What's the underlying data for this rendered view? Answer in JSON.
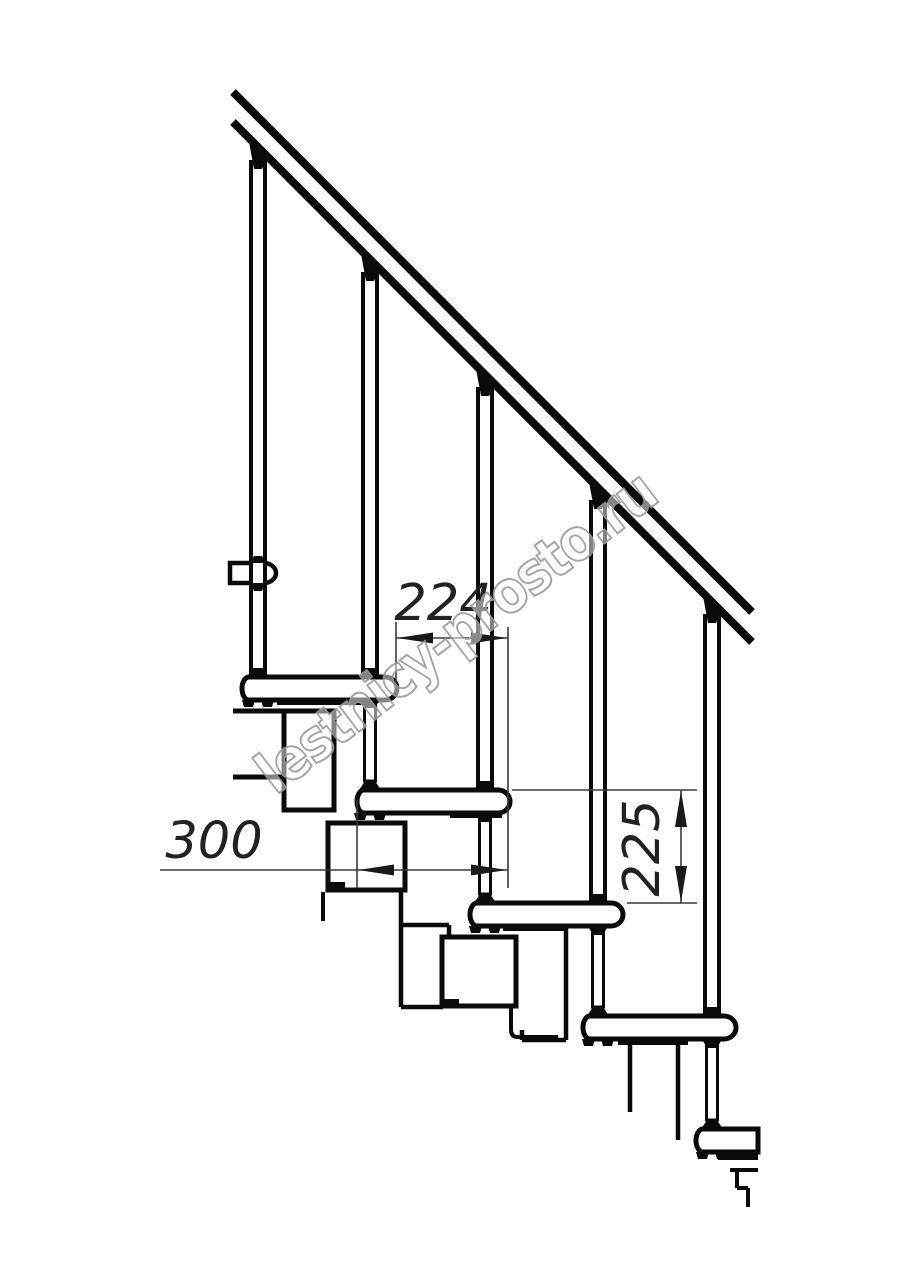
{
  "drawing": {
    "dimensions": {
      "run": "224",
      "depth": "300",
      "rise": "225"
    },
    "tread_count": 5,
    "baluster_count": 5,
    "colors": {
      "line": "#0a0a0a",
      "dimension": "#3a3a3a",
      "watermark_outline": "#9b9b9b",
      "background": "#ffffff"
    }
  },
  "watermark": {
    "text": "lestnicy-prosto.ru"
  }
}
